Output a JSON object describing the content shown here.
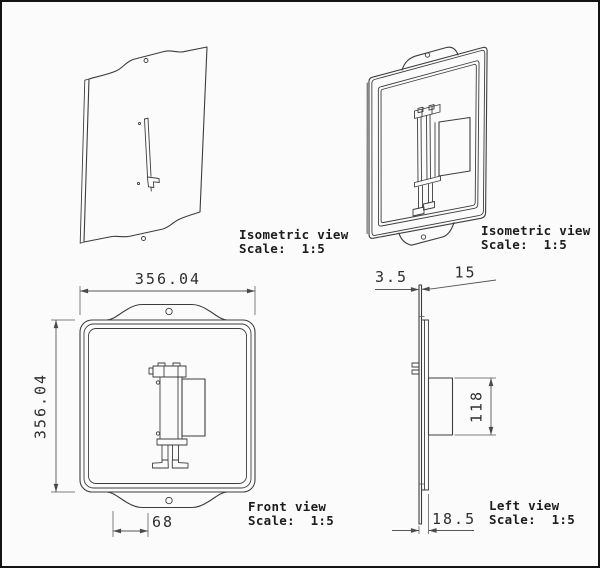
{
  "colors": {
    "background": "#fbfbfb",
    "border": "#141414",
    "line": "#3d3d3d",
    "dimension_line": "#565656",
    "text": "#1c1c1c"
  },
  "views": {
    "iso_back": {
      "title": "Isometric view",
      "scale_label": "Scale:  1:5"
    },
    "iso_front": {
      "title": "Isometric view",
      "scale_label": "Scale:  1:5"
    },
    "front": {
      "title": "Front view",
      "scale_label": "Scale:  1:5",
      "dimensions": {
        "overall_width": "356.04",
        "overall_height": "356.04",
        "tab_offset": "68"
      }
    },
    "left": {
      "title": "Left view",
      "scale_label": "Scale:  1:5",
      "dimensions": {
        "plate_thickness": "3.5",
        "frame_depth": "15",
        "bracket_height": "118",
        "total_depth": "18.5"
      }
    }
  }
}
